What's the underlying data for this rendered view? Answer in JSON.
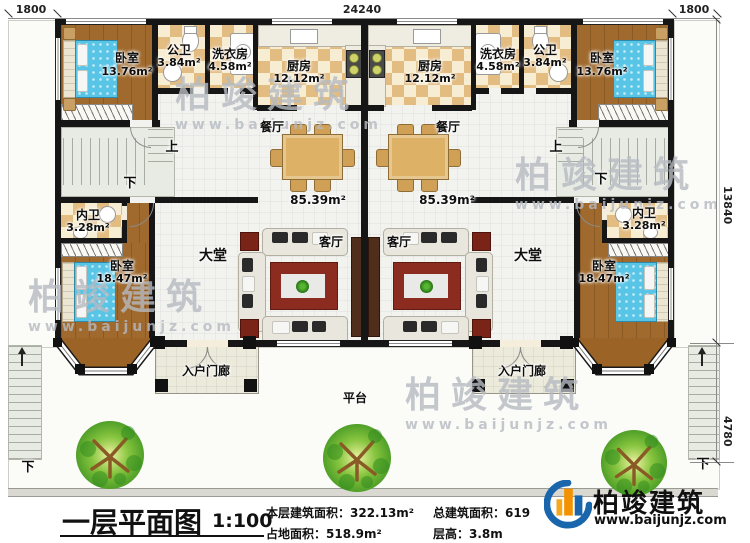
{
  "dimensions": {
    "top_left": "1800",
    "top_center": "24240",
    "top_right": "1800",
    "right_upper": "13840",
    "right_lower": "4780"
  },
  "rooms": {
    "bedroom_top": {
      "name": "卧室",
      "area": "13.76m²"
    },
    "bath_public": {
      "name": "公卫",
      "area": "3.84m²"
    },
    "laundry": {
      "name": "洗衣房",
      "area": "4.58m²"
    },
    "kitchen": {
      "name": "厨房",
      "area": "12.12m²"
    },
    "dining": {
      "name": "餐厅"
    },
    "hall": {
      "name": "大堂"
    },
    "living": {
      "name": "客厅"
    },
    "unit_area": "85.39m²",
    "bath_ensuite": {
      "name": "内卫",
      "area": "3.28m²"
    },
    "bedroom_master": {
      "name": "卧室",
      "area": "18.47m²"
    },
    "porch": {
      "name": "入户门廊"
    },
    "platform": {
      "name": "平台"
    }
  },
  "stairs": {
    "up": "上",
    "down": "下"
  },
  "title_block": {
    "title": "一层平面图",
    "scale": "1:100",
    "stat_floor_area": "本层建筑面积：322.13m²",
    "stat_footprint": "占地面积：518.9m²",
    "stat_total_area": "总建筑面积：619",
    "stat_height": "层高：3.8m"
  },
  "brand": {
    "name": "柏竣建筑",
    "url": "www.baijunjz.com"
  },
  "colors": {
    "wall": "#161616",
    "wood_floor": "#a06a2e",
    "tile_dark": "#e3bc82",
    "tile_light": "#f7edd3",
    "bed_blue": "#58c5e6",
    "logo_blue": "#1966ad",
    "logo_orange": "#f29200",
    "tree_green": "#5da832"
  }
}
